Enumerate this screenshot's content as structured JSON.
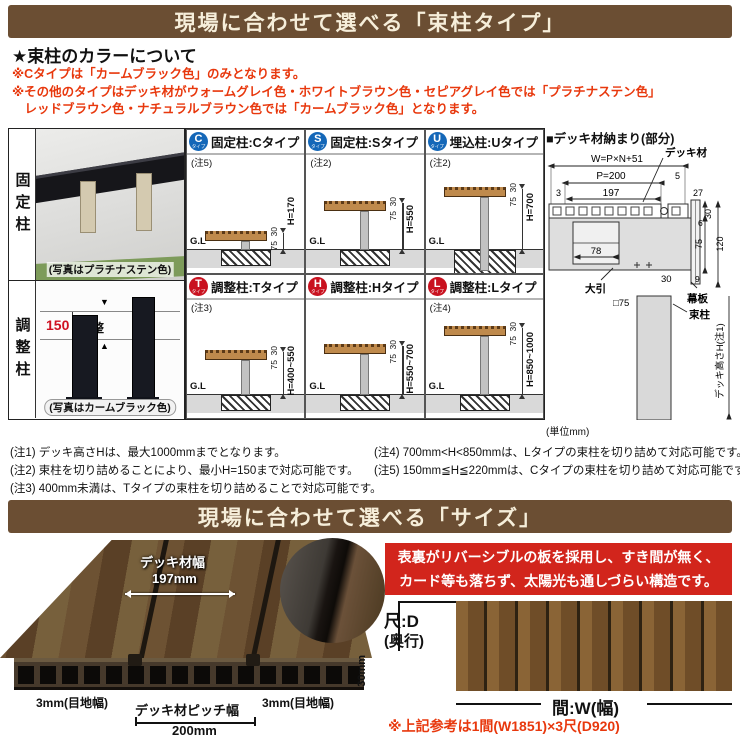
{
  "colors": {
    "header_brown": "#6b4e33",
    "header_text": "#f6eeda",
    "accent_red": "#e8380d",
    "badge_blue": "#1467b8",
    "badge_red": "#c9111f",
    "feature_red": "#d2251c",
    "wood_tan": "#bf8a4c"
  },
  "header1": {
    "title": "現場に合わせて選べる「束柱タイプ」"
  },
  "color_section": {
    "heading": "★束柱のカラーについて",
    "notes": [
      "※Cタイプは「カームブラック色」のみとなります。",
      "※その他のタイプはデッキ材がウォームグレイ色・ホワイトブラウン色・セピアグレイ色では「プラチナステン色」",
      "　レッドブラウン色・ナチュラルブラウン色では「カームブラック色」となります。"
    ]
  },
  "post_panel": {
    "fixed_label": "固定柱",
    "fixed_caption": "(写真はプラチナステン色)",
    "adjust_label": "調整柱",
    "adjust_dim": "150",
    "adjust_text": "調整",
    "adjust_caption": "(写真はカームブラック色)"
  },
  "types": [
    {
      "badge": "C",
      "badge_sub": "タイプ",
      "title": "固定柱:Cタイプ",
      "note": "(注5)",
      "dim_top": "30",
      "dim_mid": "75",
      "height": "H=170",
      "gl": "G.L"
    },
    {
      "badge": "S",
      "badge_sub": "タイプ",
      "title": "固定柱:Sタイプ",
      "note": "(注2)",
      "dim_top": "30",
      "dim_mid": "75",
      "height": "H=550",
      "gl": "G.L"
    },
    {
      "badge": "U",
      "badge_sub": "タイプ",
      "title": "埋込柱:Uタイプ",
      "note": "(注2)",
      "dim_top": "30",
      "dim_mid": "75",
      "height": "H=700",
      "gl": "G.L"
    },
    {
      "badge": "T",
      "badge_sub": "タイプ",
      "title": "調整柱:Tタイプ",
      "note": "(注3)",
      "dim_top": "30",
      "dim_mid": "75",
      "height": "H=400~550",
      "gl": "G.L"
    },
    {
      "badge": "H",
      "badge_sub": "タイプ",
      "title": "調整柱:Hタイプ",
      "note": "",
      "dim_top": "30",
      "dim_mid": "75",
      "height": "H=550~700",
      "gl": "G.L"
    },
    {
      "badge": "L",
      "badge_sub": "タイプ",
      "title": "調整柱:Lタイプ",
      "note": "(注4)",
      "dim_top": "30",
      "dim_mid": "75",
      "height": "H=850~1000",
      "gl": "G.L"
    }
  ],
  "detail_diagram": {
    "title": "■デッキ材納まり(部分)",
    "unit": "(単位mm)",
    "labels": {
      "deck": "デッキ材",
      "w_formula": "W=P×N+51",
      "p": "P=200",
      "g5": "5",
      "g3": "3",
      "g197": "197",
      "g27": "27",
      "v30_top": "30",
      "v6": "6",
      "v75": "75",
      "v120": "120",
      "v9": "9",
      "h30": "30",
      "n78": "78",
      "ooibiki": "大引",
      "post_sq": "□75",
      "makuita": "幕板",
      "tsuka": "束柱",
      "deck_h": "デッキ高さH(注1)"
    }
  },
  "notes": {
    "left": [
      "(注1) デッキ高さHは、最大1000mmまでとなります。",
      "(注2) 束柱を切り詰めることにより、最小H=150まで対応可能です。",
      "(注3) 400mm未満は、Tタイプの束柱を切り詰めることで対応可能です。"
    ],
    "right": [
      "(注4) 700mm<H<850mmは、Lタイプの束柱を切り詰めて対応可能です。",
      "(注5) 150mm≦H≦220mmは、Cタイプの束柱を切り詰めて対応可能です。"
    ]
  },
  "header2": {
    "title": "現場に合わせて選べる「サイズ」"
  },
  "size_section": {
    "deck_width_label": "デッキ材幅",
    "deck_width_value": "197mm",
    "joint_left": "3mm(目地幅)",
    "joint_right": "3mm(目地幅)",
    "pitch_label": "デッキ材ピッチ幅",
    "pitch_value": "200mm",
    "thickness": "30mm",
    "feature_lines": [
      "表裏がリバーシブルの板を採用し、すき間が無く、",
      "カード等も落ちず、太陽光も通しづらい構造です。"
    ],
    "depth_label_1": "尺:D",
    "depth_label_2": "(奥行)",
    "width_label": "間:W(幅)",
    "reference_note": "※上記参考は1間(W1851)×3尺(D920)"
  }
}
